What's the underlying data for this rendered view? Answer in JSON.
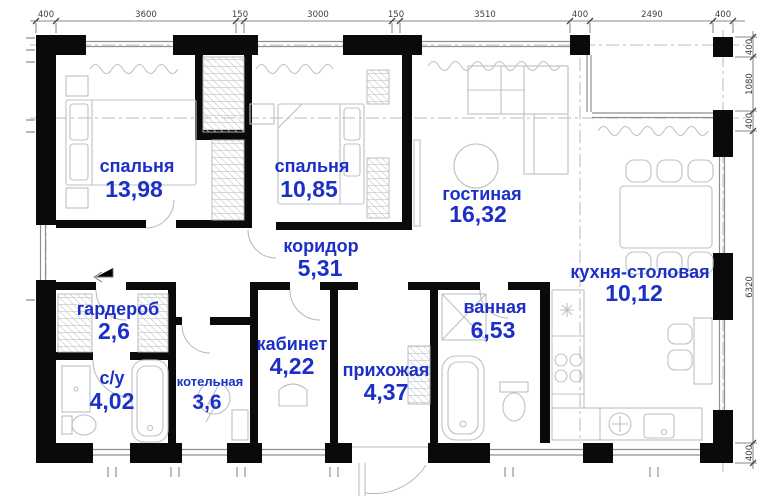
{
  "title": "apartment-floor-plan",
  "colors": {
    "label_blue": "#1c2fc7",
    "wall_black": "#0a0a0a",
    "furniture_gray": "#bcc1c7",
    "dimension_gray": "#3c4043"
  },
  "rooms": [
    {
      "name": "спальня",
      "area": "13,98"
    },
    {
      "name": "спальня",
      "area": "10,85"
    },
    {
      "name": "гостиная",
      "area": "16,32"
    },
    {
      "name": "кухня-столовая",
      "area": "10,12"
    },
    {
      "name": "коридор",
      "area": "5,31"
    },
    {
      "name": "гардероб",
      "area": "2,6"
    },
    {
      "name": "с/у",
      "area": "4,02"
    },
    {
      "name": "котельная",
      "area": "3,6"
    },
    {
      "name": "кабинет",
      "area": "4,22"
    },
    {
      "name": "прихожая",
      "area": "4,37"
    },
    {
      "name": "ванная",
      "area": "6,53"
    }
  ],
  "dimensions": {
    "top": [
      "400",
      "3600",
      "150",
      "3000",
      "150",
      "3510",
      "400",
      "2490",
      "400"
    ],
    "right": [
      "400",
      "1080",
      "400",
      "6320",
      "400"
    ]
  }
}
